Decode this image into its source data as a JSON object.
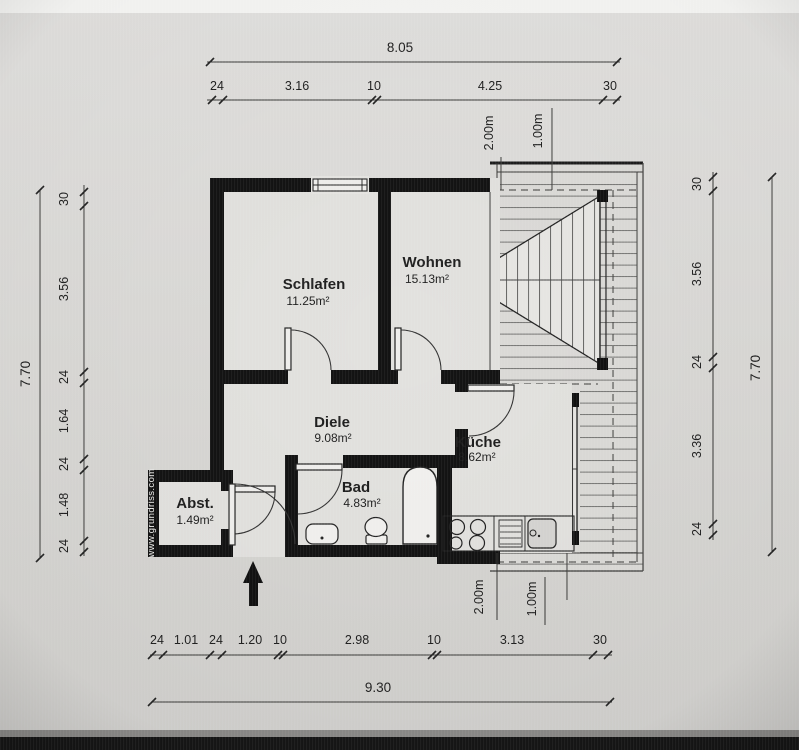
{
  "watermark": "www.grundriss.com",
  "rooms": [
    {
      "name": "Schlafen",
      "area": "11.25m²"
    },
    {
      "name": "Wohnen",
      "area": "15.13m²"
    },
    {
      "name": "Diele",
      "area": "9.08m²"
    },
    {
      "name": "Küche",
      "area": "8.62m²"
    },
    {
      "name": "Bad",
      "area": "4.83m²"
    },
    {
      "name": "Abst.",
      "area": "1.49m²"
    }
  ],
  "dims": {
    "top": {
      "overall": "8.05",
      "segs": [
        "24",
        "3.16",
        "10",
        "4.25",
        "30"
      ]
    },
    "bottom": {
      "overall": "9.30",
      "segs": [
        "24",
        "1.01",
        "24",
        "1.20",
        "10",
        "2.98",
        "10",
        "3.13",
        "30"
      ]
    },
    "left": {
      "overall": "7.70",
      "segs": [
        "30",
        "3.56",
        "24",
        "1.64",
        "24",
        "1.48",
        "24"
      ]
    },
    "right": {
      "overall": "7.70",
      "segs": [
        "30",
        "3.56",
        "24",
        "3.36",
        "24"
      ]
    }
  },
  "roof_labels": {
    "top": [
      "2.00m",
      "1.00m"
    ],
    "bottom": [
      "2.00m",
      "1.00m"
    ]
  }
}
